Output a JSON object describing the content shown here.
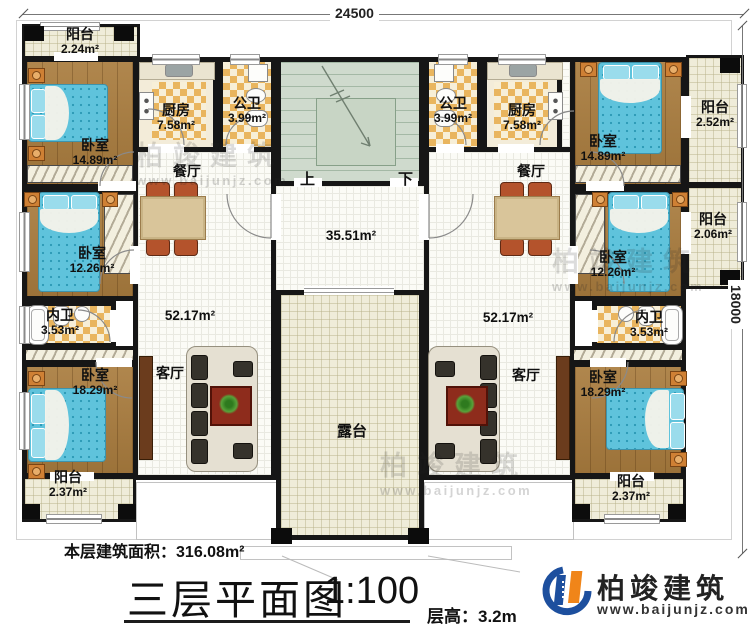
{
  "dimensions": {
    "top": "24500",
    "right": "18000"
  },
  "stairs": {
    "up": "上",
    "down": "下"
  },
  "rooms": {
    "balcony_tl": {
      "name": "阳台",
      "area": "2.24m²"
    },
    "bedroom_l1": {
      "name": "卧室",
      "area": "14.89m²"
    },
    "kitchen_l": {
      "name": "厨房",
      "area": "7.58m²"
    },
    "pubbath_l": {
      "name": "公卫",
      "area": "3.99m²"
    },
    "dining_l": {
      "name": "餐厅"
    },
    "bedroom_l2": {
      "name": "卧室",
      "area": "12.26m²"
    },
    "innerbath_l": {
      "name": "内卫",
      "area": "3.53m²"
    },
    "living_zone_l": {
      "area": "52.17m²"
    },
    "bedroom_l3": {
      "name": "卧室",
      "area": "18.29m²"
    },
    "living_l": {
      "name": "客厅"
    },
    "balcony_bl": {
      "name": "阳台",
      "area": "2.37m²"
    },
    "hall": {
      "area": "35.51m²"
    },
    "terrace": {
      "name": "露台"
    },
    "pubbath_r": {
      "name": "公卫",
      "area": "3.99m²"
    },
    "kitchen_r": {
      "name": "厨房",
      "area": "7.58m²"
    },
    "balcony_r1": {
      "name": "阳台",
      "area": "2.52m²"
    },
    "bedroom_r1": {
      "name": "卧室",
      "area": "14.89m²"
    },
    "dining_r": {
      "name": "餐厅"
    },
    "balcony_r2": {
      "name": "阳台",
      "area": "2.06m²"
    },
    "bedroom_r2": {
      "name": "卧室",
      "area": "12.26m²"
    },
    "innerbath_r": {
      "name": "内卫",
      "area": "3.53m²"
    },
    "living_zone_r": {
      "area": "52.17m²"
    },
    "bedroom_r3": {
      "name": "卧室",
      "area": "18.29m²"
    },
    "living_r": {
      "name": "客厅"
    },
    "balcony_br": {
      "name": "阳台",
      "area": "2.37m²"
    }
  },
  "footer": {
    "floor_area_label": "本层建筑面积：",
    "floor_area_value": "316.08m²",
    "title": "三层平面图",
    "scale": "1:100",
    "floor_height_label": "层高：",
    "floor_height_value": "3.2m"
  },
  "brand": {
    "name": "柏竣建筑",
    "website": "www.baijunjz.com"
  },
  "watermark": {
    "name": "柏竣建筑",
    "website": "www.baijunjz.com"
  },
  "colors": {
    "wall": "#161616",
    "wood_floor": "#a97c3e",
    "bed_blue": "#5fc3dc",
    "checker_tile": "#e9b55e",
    "stair_green": "#cfdacd",
    "terrace_cream": "#efecd9",
    "brand_blue": "#1d4f9e",
    "brand_orange": "#f08519"
  }
}
